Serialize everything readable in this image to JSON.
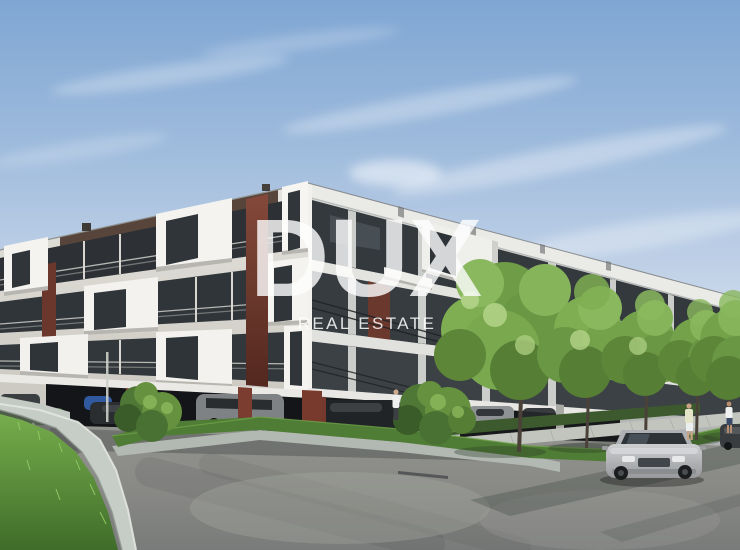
{
  "image": {
    "type": "3d-architectural-rendering",
    "subject": "Modern white apartment complex with covered ground-floor parking, curved concrete landscaping walls, street trees, pedestrians and a silver car on the road under a blue sky"
  },
  "watermark": {
    "title": "DUX",
    "subtitle": "REAL ESTATE"
  },
  "palette": {
    "sky_top": "#7fa6d3",
    "sky_horizon": "#e9eef5",
    "facade_white": "#f4f3ef",
    "facade_shaded": "#c9cbc9",
    "accent_maroon": "#7b4234",
    "window_glass": "#30353a",
    "foliage_green": "#7fae52",
    "grass_green": "#5a9a3d",
    "asphalt_gray": "#8a8b88",
    "concrete_wall": "#c6ccc6",
    "car_silver": "#b6b8ba"
  },
  "scene_objects": [
    "apartment-building",
    "covered-parking-with-cars",
    "garage-ramp-retaining-wall",
    "grass-mound",
    "ornamental-bushes",
    "street-trees",
    "sidewalk",
    "silver-sedan",
    "pedestrians",
    "distant-building"
  ]
}
